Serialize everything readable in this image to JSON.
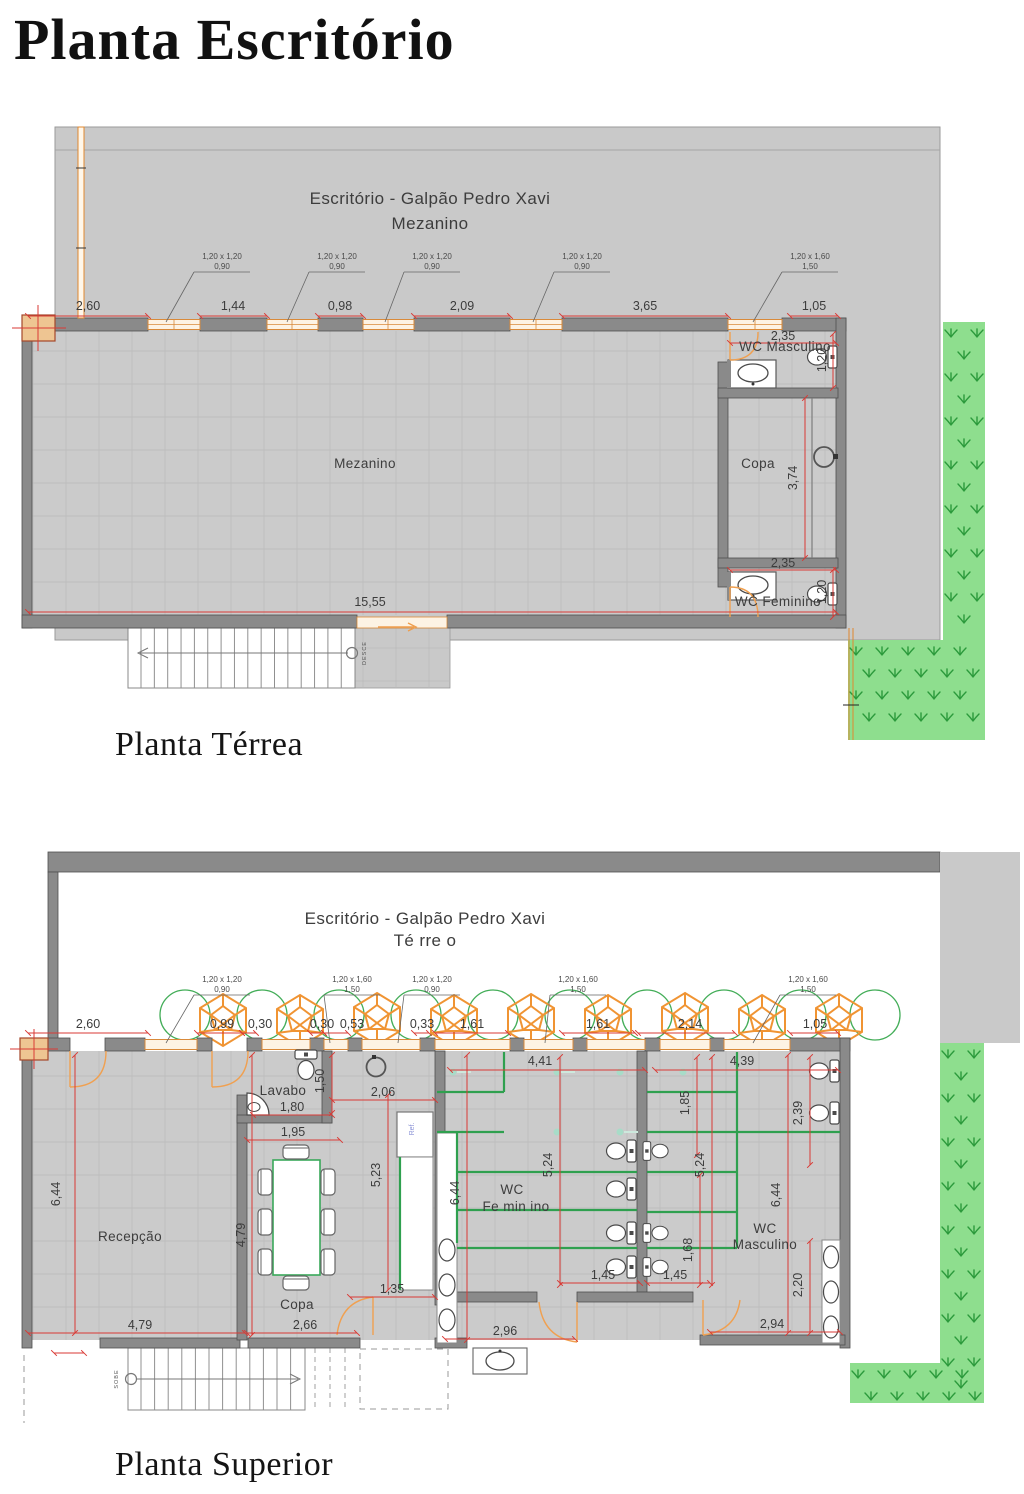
{
  "page": {
    "title": "Planta Escritório"
  },
  "colors": {
    "accent_red": "#d93a35",
    "orange": "#ee9e4e",
    "green": "#2fa04f",
    "grass_bg": "#8ede8e",
    "grass_fg": "#2c9a3c",
    "wall": "#8a8a8a",
    "floor": "#cbcbcb",
    "warehouse": "#c9c9c9"
  },
  "terrea": {
    "caption": "Planta Térrea",
    "title1": "Escritório - Galpão Pedro Xavi",
    "title2": "Mezanino",
    "room_mezanino": "Mezanino",
    "room_copa": "Copa",
    "room_wc_masculino": "WC Masculino",
    "room_wc_feminino": "WC Feminino",
    "stairs": "DESCE",
    "callouts": [
      {
        "size": "1,20 x 1,20",
        "sill": "0,90"
      },
      {
        "size": "1,20 x 1,20",
        "sill": "0,90"
      },
      {
        "size": "1,20 x 1,20",
        "sill": "0,90"
      },
      {
        "size": "1,20 x 1,20",
        "sill": "0,90"
      },
      {
        "size": "1,20 x 1,60",
        "sill": "1,50"
      }
    ],
    "dims_top": [
      "2,60",
      "1,44",
      "0,98",
      "2,09",
      "3,65",
      "1,05"
    ],
    "dim_total": "15,55",
    "dim_wcm_w": "2,35",
    "dim_wcm_h": "1,20",
    "dim_copa_h": "3,74",
    "dim_wcf_w": "2,35",
    "dim_wcf_h": "1,20"
  },
  "superior": {
    "caption": "Planta Superior",
    "title1": "Escritório - Galpão Pedro Xavi",
    "title2": "Té rre o",
    "room_recepcao": "Recepção",
    "room_copa": "Copa",
    "room_lavabo": "Lavabo",
    "room_wcf_l1": "WC",
    "room_wcf_l2": "Fe min ino",
    "room_wcm_l1": "WC",
    "room_wcm_l2": "Masculino",
    "ref_label": "Ref.",
    "stairs": "SOBE",
    "callouts": [
      {
        "size": "1,20 x 1,20",
        "sill": "0,90"
      },
      {
        "size": "1,20 x 1,60",
        "sill": "1,50"
      },
      {
        "size": "1,20 x 1,20",
        "sill": "0,90"
      },
      {
        "size": "1,20 x 1,60",
        "sill": "1,50"
      },
      {
        "size": "1,20 x 1,60",
        "sill": "1,50"
      }
    ],
    "dims_top": [
      "2,60",
      "0,99",
      "0,30",
      "0,30",
      "0,53",
      "0,33",
      "1,61",
      "1,61",
      "2,14",
      "1,05"
    ],
    "dims": {
      "d441": "4,41",
      "d439": "4,39",
      "d185": "1,85",
      "d206": "2,06",
      "d150": "1,50",
      "d180": "1,80",
      "d195": "1,95",
      "d523": "5,23",
      "d644_left": "6,44",
      "d644_fem": "6,44",
      "d644_masc": "6,44",
      "d479_vert": "4,79",
      "d479_bottom": "4,79",
      "d266": "2,66",
      "d135": "1,35",
      "d524_fem": "5,24",
      "d524_masc": "5,24",
      "d168": "1,68",
      "d145_left": "1,45",
      "d145_right": "1,45",
      "d296": "2,96",
      "d294": "2,94",
      "d239": "2,39",
      "d220": "2,20"
    }
  }
}
